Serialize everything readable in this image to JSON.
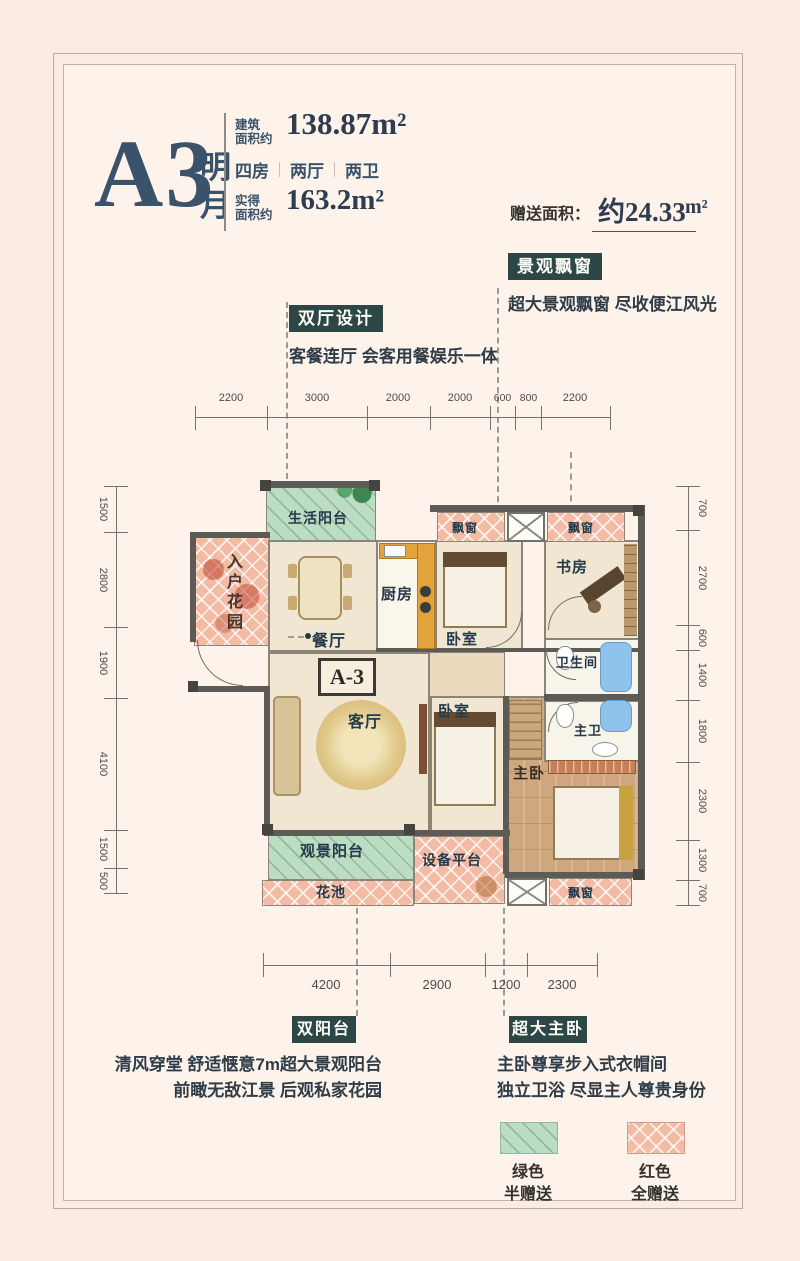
{
  "header": {
    "unit": "A3",
    "unit_suffix_1": "明",
    "unit_suffix_2": "月",
    "spec1_label_1": "建筑",
    "spec1_label_2": "面积约",
    "spec1_value": "138.87m²",
    "room_counts": [
      "四房",
      "两厅",
      "两卫"
    ],
    "spec2_label_1": "实得",
    "spec2_label_2": "面积约",
    "spec2_value": "163.2m²",
    "bonus_label": "赠送面积：",
    "bonus_value": "约24.33",
    "bonus_unit": "m²"
  },
  "callouts": {
    "dual_hall": {
      "tag": "双厅设计",
      "line1": "客餐连厅 会客用餐娱乐一体"
    },
    "bay": {
      "tag": "景观飘窗",
      "line1": "超大景观飘窗 尽收便江风光"
    },
    "dual_balcony": {
      "tag": "双阳台",
      "line1": "清风穿堂 舒适惬意7m超大景观阳台",
      "line2": "前瞰无敌江景 后观私家花园"
    },
    "master": {
      "tag": "超大主卧",
      "line1": "主卧尊享步入式衣帽间",
      "line2": "独立卫浴 尽显主人尊贵身份"
    }
  },
  "dims": {
    "top": [
      "2200",
      "3000",
      "2000",
      "2000",
      "600",
      "800",
      "2200"
    ],
    "left": [
      "1500",
      "2800",
      "1900",
      "4100",
      "1500",
      "500"
    ],
    "right": [
      "700",
      "2700",
      "600",
      "1400",
      "1800",
      "2300",
      "1300",
      "700"
    ],
    "bottom": [
      "4200",
      "2900",
      "1200",
      "2300"
    ]
  },
  "rooms": {
    "living_balcony": "生活阳台",
    "entry_garden": "入户花园",
    "dining": "餐厅",
    "kitchen": "厨房",
    "bay_top_left": "飘窗",
    "bedroom_top": "卧室",
    "bay_top_right": "飘窗",
    "study": "书房",
    "bath": "卫生间",
    "master_bath": "主卫",
    "master_bedroom": "主卧",
    "bedroom_mid": "卧室",
    "living": "客厅",
    "view_balcony": "观景阳台",
    "flower_bed": "花池",
    "equipment": "设备平台",
    "bay_bottom": "飘窗",
    "unit_box": "A-3"
  },
  "legend": {
    "green": {
      "line1": "绿色",
      "line2": "半赠送",
      "color": "#bcdcc4"
    },
    "red": {
      "line1": "红色",
      "line2": "全赠送",
      "color": "#f3bba4"
    }
  },
  "colors": {
    "accent_dark": "#2c4746",
    "navy": "#3a536a",
    "wall": "#5d5b55",
    "bonus_green": "#bcdcc4",
    "bonus_salmon": "#f3bba4"
  }
}
